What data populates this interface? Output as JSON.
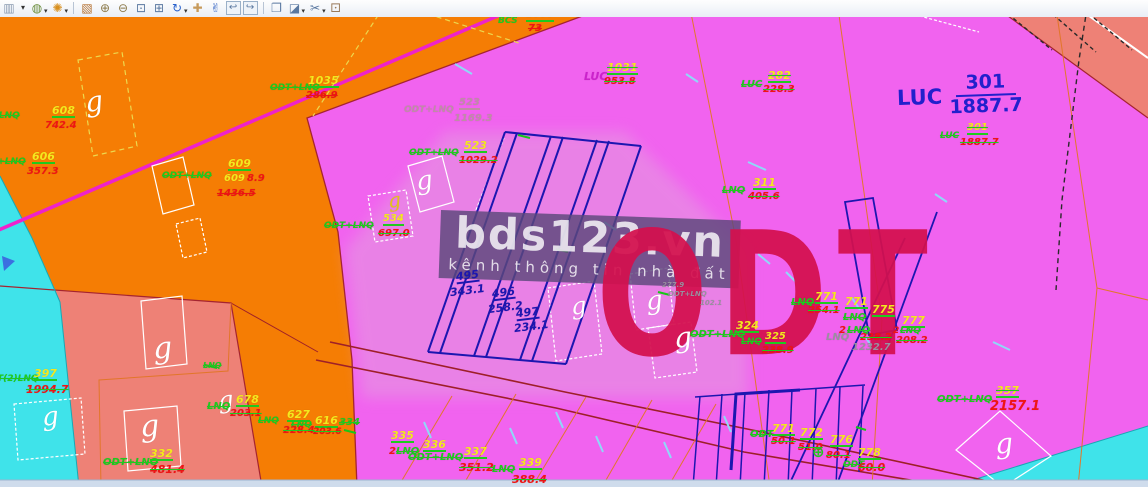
{
  "app": {
    "toolbar": {
      "items": [
        {
          "n": "window-list-icon",
          "g": "▥",
          "c": "#8a9ab0"
        },
        {
          "n": "window-list-dropdown",
          "g": "▾",
          "c": "#333333",
          "caret": 1
        },
        {
          "n": "view-display-mode-icon",
          "g": "◍",
          "c": "#6a8c3a",
          "dd": 1
        },
        {
          "n": "view-brightness-icon",
          "g": "✺",
          "c": "#d89020",
          "dd": 1
        },
        {
          "sep": 1
        },
        {
          "n": "update-view-icon",
          "g": "▧",
          "c": "#b5702f"
        },
        {
          "n": "zoom-in-icon",
          "g": "⊕",
          "c": "#8c7a4a"
        },
        {
          "n": "zoom-out-icon",
          "g": "⊖",
          "c": "#8c7a4a"
        },
        {
          "n": "window-area-icon",
          "g": "⊡",
          "c": "#5a78a0"
        },
        {
          "n": "fit-view-icon",
          "g": "⊞",
          "c": "#5a78a0"
        },
        {
          "n": "rotate-view-icon",
          "g": "↻",
          "c": "#2a62cc",
          "dd": 1
        },
        {
          "n": "pan-view-icon",
          "g": "✚",
          "c": "#c79a5b"
        },
        {
          "n": "walk-view-icon",
          "g": "✌",
          "c": "#3a68c4"
        },
        {
          "n": "view-previous-icon",
          "g": "↩",
          "c": "#5a78a0",
          "boxed": 1
        },
        {
          "n": "view-next-icon",
          "g": "↪",
          "c": "#5a78a0",
          "boxed": 1
        },
        {
          "sep": 1
        },
        {
          "n": "copy-view-icon",
          "g": "❐",
          "c": "#5a78a0"
        },
        {
          "n": "clip-volume-icon",
          "g": "◪",
          "c": "#5a78a0",
          "dd": 1
        },
        {
          "n": "clip-mask-icon",
          "g": "✂",
          "c": "#5a78a0",
          "dd": 1
        },
        {
          "n": "view-cube-icon",
          "g": "⚀",
          "c": "#9a7a5a"
        }
      ]
    }
  },
  "map": {
    "palette": {
      "pink": "#f163ef",
      "orange": "#f57d04",
      "salmon": "#ee8176",
      "cyan": "#3fe3ea",
      "lavender": "#e2a0de",
      "strip": "#cfdcec",
      "crimson": "#d4104e",
      "blue": "#2220cc",
      "band": "rgba(92,72,122,0.82)",
      "road": "#ee22cc",
      "g": "#1fca1f",
      "y": "#f4e81e",
      "r": "#ef1414",
      "nv": "#1c16b0",
      "m": "#cc22cc",
      "rose": "#c08ca6",
      "gy": "#9a8f9f",
      "w": "#ffffff",
      "yl": "#e2c31c",
      "cy": "#8fd8f8"
    },
    "watermark": {
      "title": "bds123.vn",
      "subtitle": "kênh thông tin nhà đất"
    },
    "odt_text": "ODT",
    "luc_big": {
      "code": "LUC",
      "num": "301",
      "den": "1887.7"
    },
    "labels": [
      {
        "x": 85,
        "y": 88,
        "t": "g",
        "c": "w",
        "f": 1,
        "fs": 28,
        "rot": -8
      },
      {
        "x": -30,
        "y": 112,
        "t": "ODT+LNQ",
        "c": "g",
        "s": 1
      },
      {
        "x": 52,
        "y": 105,
        "t": "608",
        "c": "y",
        "u": 1,
        "fs": 11
      },
      {
        "x": 45,
        "y": 121,
        "t": "742.4",
        "c": "r",
        "fs": 10
      },
      {
        "x": -24,
        "y": 158,
        "t": "ODT+LNQ",
        "c": "g",
        "s": 1
      },
      {
        "x": 32,
        "y": 151,
        "t": "606",
        "c": "y",
        "u": 1,
        "fs": 11
      },
      {
        "x": 27,
        "y": 167,
        "t": "357.3",
        "c": "r",
        "fs": 10
      },
      {
        "x": 162,
        "y": 172,
        "t": "ODT+LNQ",
        "c": "g",
        "s": 1
      },
      {
        "x": 228,
        "y": 158,
        "t": "609",
        "c": "y",
        "u": 1,
        "fs": 11
      },
      {
        "x": 224,
        "y": 174,
        "t": "609",
        "c": "y",
        "fs": 10
      },
      {
        "x": 247,
        "y": 174,
        "t": "8.9",
        "c": "r",
        "fs": 10
      },
      {
        "x": 217,
        "y": 189,
        "t": "1436.5",
        "c": "r",
        "s": 1,
        "fs": 10
      },
      {
        "x": 270,
        "y": 84,
        "t": "ODT+LNQ",
        "c": "g",
        "s": 1
      },
      {
        "x": 308,
        "y": 75,
        "t": "1035",
        "c": "y",
        "u": 1,
        "fs": 11
      },
      {
        "x": 306,
        "y": 91,
        "t": "286.9",
        "c": "r",
        "s": 1,
        "fs": 10
      },
      {
        "x": 498,
        "y": 17,
        "t": "BCS",
        "c": "g",
        "fs": 9
      },
      {
        "x": 526,
        "y": 10,
        "t": "2000",
        "c": "y",
        "u": 1,
        "s": 1,
        "fs": 10
      },
      {
        "x": 528,
        "y": 24,
        "t": "73",
        "c": "r",
        "s": 1,
        "fs": 10
      },
      {
        "x": 388,
        "y": 190,
        "t": "g",
        "c": "yl",
        "f": 1,
        "fs": 20,
        "rot": -8
      },
      {
        "x": 324,
        "y": 222,
        "t": "ODT+LNQ",
        "c": "g",
        "s": 1
      },
      {
        "x": 383,
        "y": 214,
        "t": "534",
        "c": "y",
        "u": 1,
        "fs": 10
      },
      {
        "x": 378,
        "y": 229,
        "t": "697.0",
        "c": "r",
        "s": "g",
        "fs": 10
      },
      {
        "x": 404,
        "y": 106,
        "t": "ODT+LNQ",
        "c": "rose",
        "fs": 9
      },
      {
        "x": 459,
        "y": 98,
        "t": "523",
        "c": "rose",
        "u": "rose",
        "fs": 10
      },
      {
        "x": 454,
        "y": 114,
        "t": "1169.3",
        "c": "rose",
        "fs": 10
      },
      {
        "x": 409,
        "y": 149,
        "t": "ODT+LNQ",
        "c": "g",
        "s": 1
      },
      {
        "x": 464,
        "y": 140,
        "t": "523",
        "c": "y",
        "u": 1,
        "fs": 11
      },
      {
        "x": 459,
        "y": 156,
        "t": "1029.2",
        "c": "r",
        "s": "g",
        "fs": 10
      },
      {
        "x": 584,
        "y": 71,
        "t": "LUC",
        "c": "m",
        "fs": 11
      },
      {
        "x": 607,
        "y": 62,
        "t": "1031",
        "c": "y",
        "u": 1,
        "s": "g",
        "fs": 11
      },
      {
        "x": 604,
        "y": 77,
        "t": "953.8",
        "c": "r",
        "s": "g",
        "fs": 10
      },
      {
        "x": 741,
        "y": 80,
        "t": "LUC",
        "c": "g",
        "s": 1,
        "fs": 10
      },
      {
        "x": 768,
        "y": 70,
        "t": "282",
        "c": "y",
        "u": 1,
        "s": "g",
        "fs": 11
      },
      {
        "x": 763,
        "y": 85,
        "t": "228.3",
        "c": "r",
        "s": "g",
        "fs": 10
      },
      {
        "x": 940,
        "y": 132,
        "t": "LUC",
        "c": "g",
        "s": 1,
        "fs": 9
      },
      {
        "x": 967,
        "y": 123,
        "t": "301",
        "c": "y",
        "u": 1,
        "s": "g",
        "fs": 10
      },
      {
        "x": 960,
        "y": 138,
        "t": "1887.7",
        "c": "r",
        "s": "g",
        "fs": 10
      },
      {
        "x": 722,
        "y": 186,
        "t": "LNQ",
        "c": "g",
        "s": 1,
        "fs": 10
      },
      {
        "x": 753,
        "y": 177,
        "t": "311",
        "c": "y",
        "u": 1,
        "fs": 11
      },
      {
        "x": 748,
        "y": 192,
        "t": "405.6",
        "c": "r",
        "s": "g",
        "fs": 10
      },
      {
        "x": 456,
        "y": 270,
        "t": "495",
        "c": "nv",
        "u": "nv",
        "fs": 11,
        "rot": -7
      },
      {
        "x": 450,
        "y": 285,
        "t": "343.1",
        "c": "nv",
        "fs": 11,
        "rot": -7
      },
      {
        "x": 492,
        "y": 287,
        "t": "496",
        "c": "nv",
        "u": "nv",
        "fs": 11,
        "rot": -7
      },
      {
        "x": 488,
        "y": 302,
        "t": "258.2",
        "c": "nv",
        "fs": 11,
        "rot": -7
      },
      {
        "x": 516,
        "y": 307,
        "t": "497",
        "c": "nv",
        "u": "nv",
        "fs": 11,
        "rot": -7
      },
      {
        "x": 514,
        "y": 321,
        "t": "234.1",
        "c": "nv",
        "fs": 11,
        "rot": -7
      },
      {
        "x": 416,
        "y": 168,
        "t": "g",
        "c": "w",
        "f": 1,
        "fs": 26,
        "rot": -8
      },
      {
        "x": 571,
        "y": 294,
        "t": "g",
        "c": "w",
        "f": 1,
        "fs": 24,
        "rot": -6
      },
      {
        "x": 646,
        "y": 288,
        "t": "g",
        "c": "w",
        "f": 1,
        "fs": 26,
        "rot": -6
      },
      {
        "x": 674,
        "y": 324,
        "t": "g",
        "c": "w",
        "f": 1,
        "fs": 28,
        "rot": -6
      },
      {
        "x": 662,
        "y": 282,
        "t": "277.9",
        "c": "gy",
        "fs": 7
      },
      {
        "x": 668,
        "y": 291,
        "t": "ODT+LNQ",
        "c": "gy",
        "fs": 7
      },
      {
        "x": 700,
        "y": 300,
        "t": "102.1",
        "c": "gy",
        "fs": 7
      },
      {
        "x": 826,
        "y": 333,
        "t": "LNQ",
        "c": "gy",
        "fs": 10
      },
      {
        "x": 852,
        "y": 343,
        "t": "1232.7",
        "c": "gy",
        "fs": 10
      },
      {
        "x": 690,
        "y": 330,
        "t": "ODT+LNQ",
        "c": "g",
        "s": 1,
        "fs": 10
      },
      {
        "x": 736,
        "y": 320,
        "t": "324",
        "c": "y",
        "u": 1,
        "fs": 11
      },
      {
        "x": 741,
        "y": 338,
        "t": "LNQ",
        "c": "g",
        "s": 1,
        "fs": 9
      },
      {
        "x": 765,
        "y": 332,
        "t": "325",
        "c": "y",
        "u": 1,
        "fs": 10
      },
      {
        "x": 762,
        "y": 346,
        "t": "238.9",
        "c": "r",
        "s": "g",
        "fs": 10
      },
      {
        "x": 791,
        "y": 298,
        "t": "LNQ",
        "c": "g",
        "s": 1,
        "fs": 10
      },
      {
        "x": 815,
        "y": 291,
        "t": "771",
        "c": "y",
        "u": 1,
        "fs": 11
      },
      {
        "x": 808,
        "y": 306,
        "t": "254.1",
        "c": "r",
        "s": "g",
        "fs": 10
      },
      {
        "x": 845,
        "y": 296,
        "t": "771",
        "c": "y",
        "u": 1,
        "fs": 11
      },
      {
        "x": 843,
        "y": 313,
        "t": "LNQ",
        "c": "g",
        "s": 1,
        "fs": 10
      },
      {
        "x": 839,
        "y": 326,
        "t": "2",
        "c": "r",
        "fs": 10
      },
      {
        "x": 847,
        "y": 326,
        "t": "LNQ",
        "c": "g",
        "s": 1,
        "fs": 10
      },
      {
        "x": 860,
        "y": 333,
        "t": "238.2",
        "c": "r",
        "s": "g",
        "fs": 10
      },
      {
        "x": 872,
        "y": 304,
        "t": "775",
        "c": "y",
        "u": 1,
        "fs": 11
      },
      {
        "x": 902,
        "y": 315,
        "t": "777",
        "c": "y",
        "u": 1,
        "fs": 11
      },
      {
        "x": 893,
        "y": 327,
        "t": "2",
        "c": "r",
        "fs": 9
      },
      {
        "x": 900,
        "y": 327,
        "t": "LNQ",
        "c": "g",
        "s": 1,
        "fs": 9
      },
      {
        "x": 896,
        "y": 336,
        "t": "208.2",
        "c": "r",
        "s": "g",
        "fs": 10
      },
      {
        "x": 750,
        "y": 430,
        "t": "ODT",
        "c": "g",
        "s": 1,
        "fs": 10
      },
      {
        "x": 772,
        "y": 423,
        "t": "771",
        "c": "y",
        "u": 1,
        "fs": 11
      },
      {
        "x": 771,
        "y": 437,
        "t": "50.1",
        "c": "r",
        "s": "g",
        "fs": 10
      },
      {
        "x": 800,
        "y": 427,
        "t": "772",
        "c": "y",
        "u": 1,
        "fs": 11
      },
      {
        "x": 798,
        "y": 443,
        "t": "51.0",
        "c": "r",
        "s": "g",
        "fs": 10
      },
      {
        "x": 812,
        "y": 445,
        "t": "⊕",
        "c": "g",
        "fs": 15
      },
      {
        "x": 830,
        "y": 434,
        "t": "776",
        "c": "y",
        "u": 1,
        "fs": 11
      },
      {
        "x": 826,
        "y": 451,
        "t": "80.1",
        "c": "r",
        "s": "g",
        "fs": 10
      },
      {
        "x": 858,
        "y": 447,
        "t": "778",
        "c": "y",
        "u": 1,
        "fs": 11
      },
      {
        "x": 843,
        "y": 461,
        "t": "ODT",
        "c": "g",
        "s": 1,
        "fs": 9
      },
      {
        "x": 858,
        "y": 462,
        "t": "60.0",
        "c": "r",
        "s": "g",
        "fs": 11
      },
      {
        "x": 218,
        "y": 388,
        "t": "g",
        "c": "w",
        "f": 1,
        "fs": 24,
        "rot": -6
      },
      {
        "x": 207,
        "y": 402,
        "t": "LNQ",
        "c": "g",
        "s": 1,
        "fs": 10
      },
      {
        "x": 236,
        "y": 394,
        "t": "678",
        "c": "y",
        "u": 1,
        "fs": 11
      },
      {
        "x": 230,
        "y": 409,
        "t": "203.1",
        "c": "r",
        "s": "g",
        "fs": 10
      },
      {
        "x": 287,
        "y": 409,
        "t": "627",
        "c": "y",
        "u": 1,
        "fs": 11
      },
      {
        "x": 315,
        "y": 415,
        "t": "616",
        "c": "y",
        "u": 1,
        "fs": 11
      },
      {
        "x": 258,
        "y": 417,
        "t": "LNQ",
        "c": "g",
        "s": 1,
        "fs": 9
      },
      {
        "x": 291,
        "y": 421,
        "t": "LNQ",
        "c": "g",
        "s": 1,
        "fs": 9
      },
      {
        "x": 283,
        "y": 426,
        "t": "228.4",
        "c": "r",
        "s": "g",
        "fs": 10
      },
      {
        "x": 313,
        "y": 428,
        "t": "203.6",
        "c": "r",
        "s": "g",
        "fs": 9
      },
      {
        "x": 339,
        "y": 418,
        "t": "334",
        "c": "g",
        "s": 1,
        "fs": 10
      },
      {
        "x": 391,
        "y": 430,
        "t": "335",
        "c": "y",
        "u": 1,
        "fs": 11
      },
      {
        "x": 423,
        "y": 439,
        "t": "336",
        "c": "y",
        "u": 1,
        "fs": 11
      },
      {
        "x": 389,
        "y": 447,
        "t": "2",
        "c": "r",
        "fs": 10
      },
      {
        "x": 396,
        "y": 447,
        "t": "LNQ",
        "c": "g",
        "s": 1,
        "fs": 10
      },
      {
        "x": 408,
        "y": 453,
        "t": "ODT+LNQ",
        "c": "g",
        "s": 1,
        "fs": 10
      },
      {
        "x": 464,
        "y": 446,
        "t": "337",
        "c": "y",
        "u": 1,
        "fs": 11
      },
      {
        "x": 459,
        "y": 462,
        "t": "351.2",
        "c": "r",
        "s": "g",
        "fs": 11
      },
      {
        "x": 519,
        "y": 457,
        "t": "339",
        "c": "y",
        "u": 1,
        "fs": 11
      },
      {
        "x": 492,
        "y": 465,
        "t": "LNQ",
        "c": "g",
        "s": 1,
        "fs": 10
      },
      {
        "x": 512,
        "y": 474,
        "t": "388.4",
        "c": "r",
        "s": "g",
        "fs": 11
      },
      {
        "x": 153,
        "y": 334,
        "t": "g",
        "c": "w",
        "f": 1,
        "fs": 30,
        "rot": -5
      },
      {
        "x": 140,
        "y": 412,
        "t": "g",
        "c": "w",
        "f": 1,
        "fs": 30,
        "rot": -5
      },
      {
        "x": 42,
        "y": 404,
        "t": "g",
        "c": "w",
        "f": 1,
        "fs": 26,
        "rot": -5
      },
      {
        "x": -3,
        "y": 375,
        "t": "T(2)LNQ",
        "c": "g",
        "s": 1,
        "fs": 9
      },
      {
        "x": 34,
        "y": 368,
        "t": "397",
        "c": "y",
        "u": 1,
        "fs": 11
      },
      {
        "x": 26,
        "y": 384,
        "t": "1994.7",
        "c": "r",
        "s": "g",
        "fs": 11
      },
      {
        "x": 103,
        "y": 458,
        "t": "ODT+LNQ",
        "c": "g",
        "s": 1,
        "fs": 10
      },
      {
        "x": 150,
        "y": 448,
        "t": "332",
        "c": "y",
        "u": 1,
        "fs": 11
      },
      {
        "x": 150,
        "y": 464,
        "t": "481.4",
        "c": "r",
        "s": "g",
        "fs": 11
      },
      {
        "x": 203,
        "y": 362,
        "t": "LNQ",
        "c": "g",
        "s": 1,
        "fs": 8
      },
      {
        "x": 937,
        "y": 395,
        "t": "ODT+LNQ",
        "c": "g",
        "s": 1,
        "fs": 10
      },
      {
        "x": 996,
        "y": 385,
        "t": "357",
        "c": "y",
        "u": 1,
        "s": "g",
        "fs": 11
      },
      {
        "x": 990,
        "y": 400,
        "t": "2157.1",
        "c": "r",
        "fs": 13
      },
      {
        "x": 995,
        "y": 430,
        "t": "g",
        "c": "w",
        "f": 1,
        "fs": 28,
        "rot": -5
      }
    ]
  }
}
